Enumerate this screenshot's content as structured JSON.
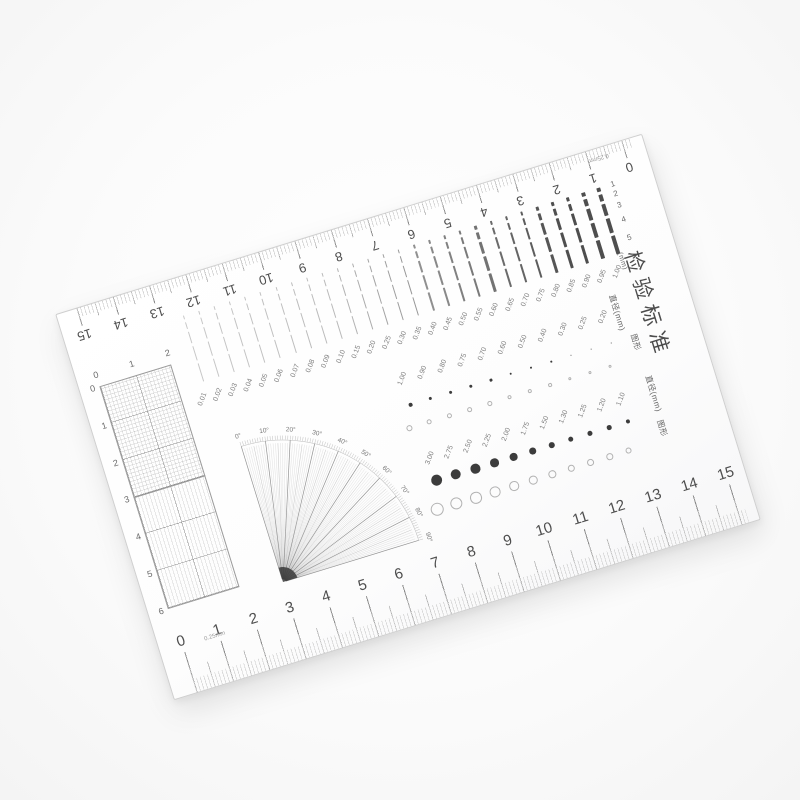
{
  "card": {
    "title_chars": [
      "检",
      "验",
      "标",
      "准"
    ],
    "rulers": {
      "numbers": [
        "0",
        "1",
        "2",
        "3",
        "4",
        "5",
        "6",
        "7",
        "8",
        "9",
        "10",
        "11",
        "12",
        "13",
        "14",
        "15"
      ],
      "division_note": "0.25mm"
    },
    "line_gauge": {
      "unit_label": "(mm)",
      "row_labels": [
        "1",
        "2",
        "3",
        "4",
        "5"
      ],
      "widths_mm": [
        "1.00",
        "0.95",
        "0.90",
        "0.85",
        "0.80",
        "0.75",
        "0.70",
        "0.65",
        "0.60",
        "0.55",
        "0.50",
        "0.45",
        "0.40",
        "0.35",
        "0.30",
        "0.25",
        "0.20",
        "0.15",
        "0.10",
        "0.09",
        "0.08",
        "0.07",
        "0.06",
        "0.05",
        "0.04",
        "0.03",
        "0.02",
        "0.01"
      ]
    },
    "dot_gauge_small": {
      "diameter_label": "直径(mm)",
      "figure_label": "图形",
      "values_mm": [
        "0.20",
        "0.25",
        "0.30",
        "0.40",
        "0.50",
        "0.60",
        "0.70",
        "0.75",
        "0.80",
        "0.90",
        "1.00"
      ]
    },
    "dot_gauge_large": {
      "diameter_label": "直径(mm)",
      "figure_label": "图形",
      "values_mm": [
        "1.10",
        "1.20",
        "1.25",
        "1.30",
        "1.50",
        "1.75",
        "2.00",
        "2.25",
        "2.50",
        "2.75",
        "3.00"
      ]
    },
    "protractor": {
      "degree_labels": [
        "0°",
        "10°",
        "20°",
        "30°",
        "40°",
        "50°",
        "60°",
        "70°",
        "80°",
        "90°"
      ]
    },
    "grid": {
      "col_labels": [
        "0",
        "1",
        "2"
      ],
      "row_labels": [
        "0",
        "1",
        "2",
        "3",
        "4",
        "5",
        "6"
      ]
    }
  }
}
